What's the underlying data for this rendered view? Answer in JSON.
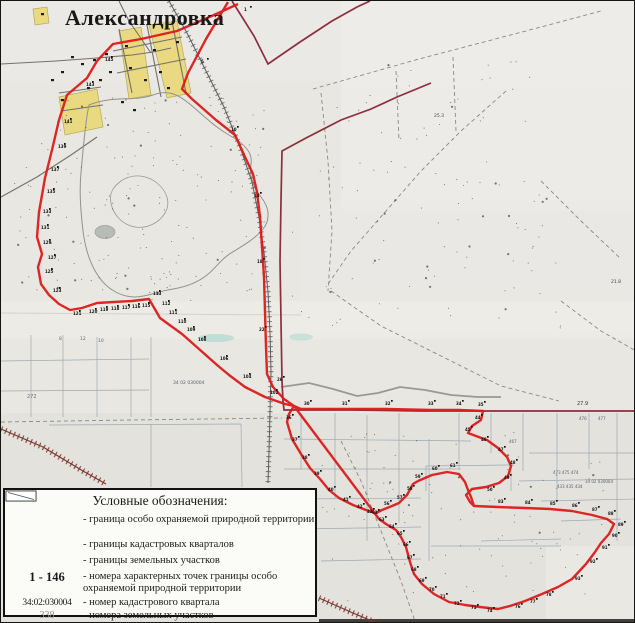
{
  "map": {
    "title": "Александровка",
    "colors": {
      "protected_boundary": "#dd1b1b",
      "cadastral_quarter": "#8c2e3c",
      "parcel_line": "#8fa0ae",
      "railroad": "#5c5c5c",
      "railroad_dark": "#7a372f",
      "village_block": "#ead97c",
      "paper": "#e8e7e2"
    },
    "paths": {
      "red_west": "M237,3 L213,14 L176,30 L140,38 L112,43 L96,60 L86,77 L66,94 L58,119 L51,149 L44,177 L38,211 L36,236 L41,253 L37,266 L40,283 L48,294 L58,303 L69,309 L81,307 L96,302 L113,301 L131,300 L148,298 L159,317 L181,333 L198,348 L216,364 L228,374 L244,386 L264,396 L284,403 L293,405",
      "red_east": "M227,1 L205,38 L187,72 L181,88 L191,98 L215,119 L234,134 L244,156 L252,173 L256,191 L259,216 L261,246 L263,276 L264,311 L265,346 L266,373 L272,386 L283,398 L293,405",
      "red_wiggle": "M293,405 L300,408 L340,408 L385,408 L430,409 L458,409 L482,410 L480,419 L471,425 L467,432 L475,435 L486,439 L497,447 L506,456 L510,465 L507,475 L498,482 L485,486 L471,488 L465,494 L469,501 L473,505",
      "red_south": "M293,405 L288,413 L286,421 L291,438 L300,453 L309,467 L319,478 L328,489 L338,497 L352,504 L365,509 L375,512 L381,509 L391,505 L398,502 L406,494 L412,483 L417,480 L431,474 L446,471 L458,473 L464,481 L467,489 L470,496 L473,505 L497,506 L524,507 L549,508 L571,510 L591,514 L606,518 L613,523 L608,533 L600,542 L594,551 L585,563 L571,578 L557,586 L541,593 L524,600 L509,605 L497,608 L479,606 L464,604 L448,601 L433,593 L421,583 L413,573 L409,561 L405,546 L400,536 L395,529 L385,523 L378,518 Z",
      "maroon_top": "M231,0 L253,35 L267,63 L299,41 L331,20 L356,6 L369,0",
      "maroon_main": "M430,82 L396,96 L370,108 L340,119 L305,137 L281,150 L280,200 L279,260 L280,320 L281,380 L282,400 L283,409 L350,409 L420,410 L500,410 L565,410 L635,410",
      "rail1": "M168,0 L186,32 L206,72 L223,106 L239,146 L251,181 L258,216 L263,251 L267,291 L269,331 L270,371 L269,411 L268,451 L267,482",
      "rail2a": "M0,428 L42,446 L82,470 L105,483",
      "rail2b": "M318,597 L352,612 L378,623",
      "grid_se": "M300,412 L300,468 M334,412 L334,498 M366,414 L366,540 M398,412 L398,522 M428,438 L428,560 M458,412 L458,468 M490,412 L490,452 M522,412 L522,470 M556,412 L556,500 M588,412 L588,468 M616,412 L616,540 M283,438 L470,440 M283,468 L460,468 M300,498 L420,497 M528,452 L635,452 M518,480 L635,478 M540,500 L635,498 M300,528 L420,526 M430,545 L560,545 M560,520 L620,518 M320,560 L420,558 M480,540 L560,538 M425,465 L510,464 L510,490 M425,465 L425,490",
      "grid_sw": "M30,334 L30,416 M62,334 L62,416 M96,336 L96,416 M130,336 L130,416 M0,360 L148,358 M0,390 L148,389 M150,336 L150,416 M48,424 L240,423 L241,486 M150,423 L150,486",
      "dashed": "M312,88 L418,58 L540,26 L600,10 M320,92 L327,160 L331,230 L327,290 M505,90 L460,130 L420,170 L385,210 L350,250 L325,286 M330,290 L380,325 L440,355 L500,385 L558,400 M0,421 L130,419 L281,417 M340,440 L360,480 L380,530 L400,580 L414,620 M560,300 L600,330 L635,350 M540,180 L580,220 L620,258 M452,56 L455,130 M395,70 L398,140",
      "forest": "M88,104 C112,94 132,101 152,94 C168,88 178,94 190,104 C204,116 214,126 228,134 C244,143 252,152 250,163 C248,174 252,186 260,196 C268,206 270,218 262,228 C254,238 240,246 230,252 C220,258 214,268 206,274 C196,282 184,286 172,288 C158,290 146,296 134,296 C120,296 106,288 98,276 C88,262 84,246 82,230 C80,212 78,192 80,172 C82,150 84,122 88,104 Z",
      "forest_inner": "M120,180 C132,172 146,174 156,182 C166,190 170,202 164,212 C158,222 146,228 134,226 C122,224 112,214 110,202 C108,192 112,186 120,180 Z",
      "road_mid": "M280,386 L308,382 L332,388 L356,395 L377,392 L399,386 L424,389 L450,394 L477,396 L500,396",
      "roads_village": "M0,63 L55,60 L96,57 L131,54 L152,51 L170,47 M118,28 L131,92 M146,24 L160,96 M171,20 L185,92 M112,50 L181,36 M116,72 L185,58 M58,92 L100,86 M60,110 L102,104 M0,196 L36,176 L70,154 L96,136 M150,52 L128,20 L118,0"
    },
    "labels": [
      {
        "t": "145",
        "x": 104,
        "y": 60,
        "p": 1
      },
      {
        "t": "143",
        "x": 85,
        "y": 85,
        "p": 1
      },
      {
        "t": "141",
        "x": 63,
        "y": 122,
        "p": 1
      },
      {
        "t": "139",
        "x": 57,
        "y": 147,
        "p": 1
      },
      {
        "t": "137",
        "x": 50,
        "y": 170,
        "p": 1
      },
      {
        "t": "135",
        "x": 46,
        "y": 192,
        "p": 1
      },
      {
        "t": "133",
        "x": 42,
        "y": 212,
        "p": 1
      },
      {
        "t": "131",
        "x": 40,
        "y": 228,
        "p": 1
      },
      {
        "t": "129",
        "x": 42,
        "y": 243,
        "p": 1
      },
      {
        "t": "127",
        "x": 47,
        "y": 258,
        "p": 1
      },
      {
        "t": "125",
        "x": 44,
        "y": 272,
        "p": 1
      },
      {
        "t": "123",
        "x": 52,
        "y": 291,
        "p": 1
      },
      {
        "t": "121",
        "x": 72,
        "y": 314,
        "p": 1
      },
      {
        "t": "120",
        "x": 88,
        "y": 312,
        "p": 1
      },
      {
        "t": "119",
        "x": 99,
        "y": 310,
        "p": 1
      },
      {
        "t": "118",
        "x": 110,
        "y": 309,
        "p": 1
      },
      {
        "t": "117",
        "x": 121,
        "y": 308,
        "p": 1
      },
      {
        "t": "116",
        "x": 131,
        "y": 307,
        "p": 1
      },
      {
        "t": "115",
        "x": 141,
        "y": 306,
        "p": 1
      },
      {
        "t": "113",
        "x": 152,
        "y": 294,
        "p": 1
      },
      {
        "t": "112",
        "x": 161,
        "y": 304,
        "p": 1
      },
      {
        "t": "111",
        "x": 168,
        "y": 313,
        "p": 1
      },
      {
        "t": "110",
        "x": 177,
        "y": 322,
        "p": 1
      },
      {
        "t": "109",
        "x": 186,
        "y": 330,
        "p": 1
      },
      {
        "t": "108",
        "x": 197,
        "y": 340,
        "p": 1
      },
      {
        "t": "106",
        "x": 219,
        "y": 359,
        "p": 1
      },
      {
        "t": "104",
        "x": 242,
        "y": 377,
        "p": 1
      },
      {
        "t": "102",
        "x": 269,
        "y": 393,
        "p": 1
      },
      {
        "t": "1",
        "x": 243,
        "y": 10,
        "p": 1
      },
      {
        "t": "5",
        "x": 200,
        "y": 62,
        "p": 1
      },
      {
        "t": "10",
        "x": 230,
        "y": 130,
        "p": 1
      },
      {
        "t": "14",
        "x": 253,
        "y": 196,
        "p": 1
      },
      {
        "t": "18",
        "x": 256,
        "y": 262,
        "p": 1
      },
      {
        "t": "22",
        "x": 258,
        "y": 330,
        "p": 1
      },
      {
        "t": "26",
        "x": 276,
        "y": 380,
        "p": 1
      },
      {
        "t": "30",
        "x": 303,
        "y": 404,
        "p": 1
      },
      {
        "t": "31",
        "x": 341,
        "y": 404,
        "p": 1
      },
      {
        "t": "32",
        "x": 384,
        "y": 404,
        "p": 1
      },
      {
        "t": "33",
        "x": 427,
        "y": 404,
        "p": 1
      },
      {
        "t": "34",
        "x": 455,
        "y": 404,
        "p": 1
      },
      {
        "t": "35",
        "x": 477,
        "y": 405,
        "p": 1
      },
      {
        "t": "36",
        "x": 285,
        "y": 418,
        "p": 1
      },
      {
        "t": "37",
        "x": 291,
        "y": 440,
        "p": 1
      },
      {
        "t": "38",
        "x": 301,
        "y": 458,
        "p": 1
      },
      {
        "t": "39",
        "x": 313,
        "y": 474,
        "p": 1
      },
      {
        "t": "40",
        "x": 327,
        "y": 490,
        "p": 1
      },
      {
        "t": "41",
        "x": 342,
        "y": 500,
        "p": 1
      },
      {
        "t": "42",
        "x": 356,
        "y": 507,
        "p": 1
      },
      {
        "t": "43",
        "x": 366,
        "y": 512,
        "p": 1
      },
      {
        "t": "44",
        "x": 474,
        "y": 418,
        "p": 1
      },
      {
        "t": "45",
        "x": 464,
        "y": 430,
        "p": 1
      },
      {
        "t": "46",
        "x": 480,
        "y": 440,
        "p": 1
      },
      {
        "t": "47",
        "x": 497,
        "y": 450,
        "p": 1
      },
      {
        "t": "48",
        "x": 509,
        "y": 463,
        "p": 1
      },
      {
        "t": "49",
        "x": 503,
        "y": 478,
        "p": 1
      },
      {
        "t": "50",
        "x": 486,
        "y": 490,
        "p": 1
      },
      {
        "t": "56",
        "x": 383,
        "y": 504,
        "p": 1
      },
      {
        "t": "57",
        "x": 396,
        "y": 498,
        "p": 1
      },
      {
        "t": "58",
        "x": 406,
        "y": 489,
        "p": 1
      },
      {
        "t": "59",
        "x": 414,
        "y": 477,
        "p": 1
      },
      {
        "t": "60",
        "x": 431,
        "y": 469,
        "p": 1
      },
      {
        "t": "61",
        "x": 449,
        "y": 466,
        "p": 1
      },
      {
        "t": "62",
        "x": 371,
        "y": 513,
        "p": 1
      },
      {
        "t": "63",
        "x": 378,
        "y": 520,
        "p": 1
      },
      {
        "t": "64",
        "x": 388,
        "y": 527,
        "p": 1
      },
      {
        "t": "65",
        "x": 396,
        "y": 534,
        "p": 1
      },
      {
        "t": "66",
        "x": 402,
        "y": 545,
        "p": 1
      },
      {
        "t": "67",
        "x": 406,
        "y": 558,
        "p": 1
      },
      {
        "t": "68",
        "x": 410,
        "y": 570,
        "p": 1
      },
      {
        "t": "69",
        "x": 418,
        "y": 581,
        "p": 1
      },
      {
        "t": "70",
        "x": 428,
        "y": 590,
        "p": 1
      },
      {
        "t": "71",
        "x": 439,
        "y": 597,
        "p": 1
      },
      {
        "t": "72",
        "x": 453,
        "y": 604,
        "p": 1
      },
      {
        "t": "73",
        "x": 470,
        "y": 608,
        "p": 1
      },
      {
        "t": "74",
        "x": 486,
        "y": 611,
        "p": 1
      },
      {
        "t": "76",
        "x": 514,
        "y": 607,
        "p": 1
      },
      {
        "t": "77",
        "x": 529,
        "y": 602,
        "p": 1
      },
      {
        "t": "78",
        "x": 545,
        "y": 595,
        "p": 1
      },
      {
        "t": "83",
        "x": 497,
        "y": 502,
        "p": 1
      },
      {
        "t": "84",
        "x": 524,
        "y": 503,
        "p": 1
      },
      {
        "t": "85",
        "x": 549,
        "y": 504,
        "p": 1
      },
      {
        "t": "86",
        "x": 571,
        "y": 506,
        "p": 1
      },
      {
        "t": "87",
        "x": 591,
        "y": 510,
        "p": 1
      },
      {
        "t": "88",
        "x": 607,
        "y": 514,
        "p": 1
      },
      {
        "t": "89",
        "x": 617,
        "y": 525,
        "p": 1
      },
      {
        "t": "90",
        "x": 611,
        "y": 536,
        "p": 1
      },
      {
        "t": "91",
        "x": 601,
        "y": 548,
        "p": 1
      },
      {
        "t": "92",
        "x": 589,
        "y": 562,
        "p": 1
      },
      {
        "t": "93",
        "x": 574,
        "y": 579,
        "p": 1
      },
      {
        "t": "34 02 030004",
        "x": 172,
        "y": 383,
        "s": 4.5,
        "c": "#5a626c"
      },
      {
        "t": "34 02 030004",
        "x": 584,
        "y": 482,
        "s": 4,
        "c": "#5a626c"
      },
      {
        "t": "27.9",
        "x": 576,
        "y": 404,
        "s": 5,
        "c": "#333333"
      },
      {
        "t": "25.3",
        "x": 433,
        "y": 116,
        "s": 4.5,
        "c": "#444444"
      },
      {
        "t": "21.8",
        "x": 610,
        "y": 282,
        "s": 4.5,
        "c": "#444444"
      },
      {
        "t": "272",
        "x": 26,
        "y": 397,
        "s": 5,
        "c": "#6a6a6a"
      },
      {
        "t": "8",
        "x": 58,
        "y": 339,
        "s": 4.5,
        "c": "#6a6a6a"
      },
      {
        "t": "12",
        "x": 79,
        "y": 339,
        "s": 4.5,
        "c": "#6a6a6a"
      },
      {
        "t": "10",
        "x": 97,
        "y": 341,
        "s": 4.5,
        "c": "#6a6a6a"
      },
      {
        "t": "473 475 474",
        "x": 552,
        "y": 473,
        "s": 4,
        "c": "#5a626c"
      },
      {
        "t": "433 435 434",
        "x": 556,
        "y": 487,
        "s": 4,
        "c": "#5a626c"
      },
      {
        "t": "476",
        "x": 578,
        "y": 419,
        "s": 4,
        "c": "#5a626c"
      },
      {
        "t": "477",
        "x": 597,
        "y": 419,
        "s": 4,
        "c": "#5a626c"
      },
      {
        "t": "467",
        "x": 508,
        "y": 442,
        "s": 4,
        "c": "#5a626c"
      }
    ]
  },
  "legend": {
    "title": "Условные обозначения:",
    "item1_label": "- граница особо охраняемой природной территории",
    "item2_label": "- границы кадастровых кварталов",
    "item3_label": "- границы земельных участков",
    "item4_symbol": "1 - 146",
    "item4_label": "- номера характерных точек границы особо охраняемой природной территории",
    "item5_symbol": "34:02:030004",
    "item5_label": "- номер кадастрового квартала",
    "item6_symbol": "338",
    "item6_label": "- номера земельных участков",
    "scale": "Масштаб 1:30 000"
  }
}
